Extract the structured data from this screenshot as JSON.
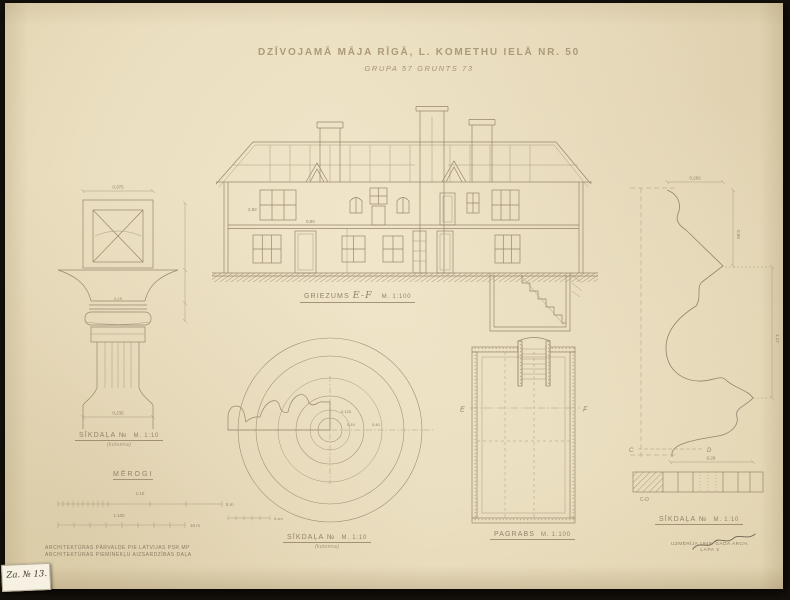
{
  "title": {
    "main": "DZĪVOJAMĀ MĀJA RĪGĀ, L. KOMETHU IELĀ NR. 50",
    "sub": "GRUPA 57   GRUNTS 73"
  },
  "captions": {
    "column": {
      "label": "SĪKDAĻA №",
      "scale": "M. 1:10",
      "sub": "(kolonna)"
    },
    "section": {
      "label": "GRIEZUMS",
      "id": "E-F",
      "scale": "M. 1:100"
    },
    "scales": {
      "heading": "MĒROGI",
      "bar1": "1:10",
      "bar1_end": "5 m",
      "bar2": "1:100",
      "bar2_end": "10 m"
    },
    "round": {
      "label": "SĪKDAĻA №",
      "scale": "M. 1:10",
      "sub": "(kolonna)",
      "mini_end": "5 cm"
    },
    "basement": {
      "label": "PAGRABS",
      "scale": "M. 1:100",
      "e": "E",
      "f": "F"
    },
    "profile": {
      "label": "SĪKDAĻA №",
      "scale": "M. 1:10",
      "c": "C",
      "d": "D",
      "cd": "C-D"
    }
  },
  "dims": {
    "column_top": "0,375",
    "column_neck": "0,19",
    "column_base": "0,235",
    "section_a": "2,92",
    "section_b": "0,90",
    "round_a": "0,125",
    "round_b": "0,19",
    "round_c": "0,40",
    "profile_top": "0,282",
    "profile_right1": "0,58",
    "profile_right2": "1,17",
    "profile_bottom": "0,28"
  },
  "footer": {
    "org1": "ARCHITEKTŪRAS PĀRVALDE PIE LATVIJAS PSR MP",
    "org2": "ARCHITEKTŪRAS PIEMINEKĻU AIZSARDZĪBAS DAĻA",
    "credit1": "UZMĒRĪJA 1949. GADĀ ARCH.",
    "credit2": "LAPA 2",
    "tag": "Za. № 13."
  },
  "colors": {
    "paper": "#ebdfc1",
    "backdrop": "#14100a",
    "pencil": "#97876c",
    "ink": "#3c3428"
  }
}
